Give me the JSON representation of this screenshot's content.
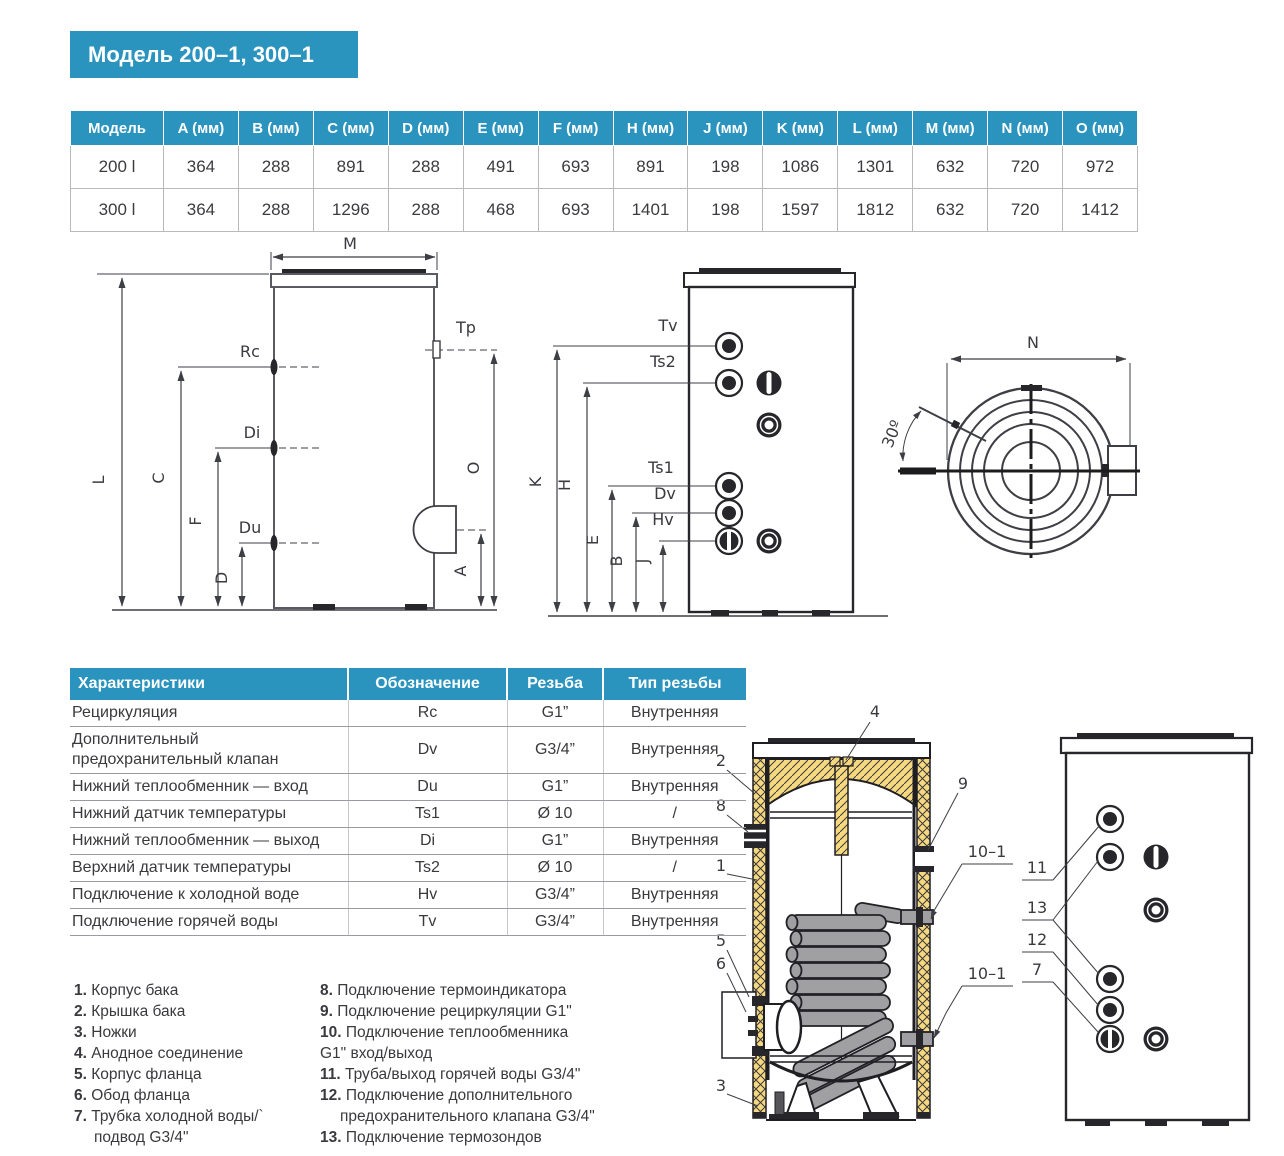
{
  "page": {
    "title": "Модель 200–1, 300–1"
  },
  "colors": {
    "accent": "#2b94be",
    "insulation": "#f6d87e",
    "line": "#3e3f45",
    "dark": "#1f1f23"
  },
  "dim_table": {
    "headers": [
      "Модель",
      "A (мм)",
      "B (мм)",
      "C (мм)",
      "D (мм)",
      "E (мм)",
      "F (мм)",
      "H (мм)",
      "J (мм)",
      "K (мм)",
      "L (мм)",
      "M (мм)",
      "N (мм)",
      "O (мм)"
    ],
    "rows": [
      [
        "200 l",
        "364",
        "288",
        "891",
        "288",
        "491",
        "693",
        "891",
        "198",
        "1086",
        "1301",
        "632",
        "720",
        "972"
      ],
      [
        "300 l",
        "364",
        "288",
        "1296",
        "288",
        "468",
        "693",
        "1401",
        "198",
        "1597",
        "1812",
        "632",
        "720",
        "1412"
      ]
    ]
  },
  "char_table": {
    "headers": [
      "Характеристики",
      "Обозначение",
      "Резьба",
      "Тип резьбы"
    ],
    "rows": [
      [
        "Рециркуляция",
        "Rc",
        "G1”",
        "Внутренняя"
      ],
      [
        "Дополнительный предохранительный клапан",
        "Dv",
        "G3/4”",
        "Внутренняя"
      ],
      [
        "Нижний теплообменник — вход",
        "Du",
        "G1”",
        "Внутренняя"
      ],
      [
        "Нижний датчик температуры",
        "Ts1",
        "Ø 10",
        "/"
      ],
      [
        "Нижний теплообменник  — выход",
        "Di",
        "G1”",
        "Внутренняя"
      ],
      [
        "Верхний датчик температуры",
        "Ts2",
        "Ø 10",
        "/"
      ],
      [
        "Подключение к холодной воде",
        "Hv",
        "G3/4”",
        "Внутренняя"
      ],
      [
        "Подключение горячей воды",
        "Tv",
        "G3/4”",
        "Внутренняя"
      ]
    ]
  },
  "legend_left": [
    {
      "num": "1",
      "lines": [
        "Корпус бака"
      ]
    },
    {
      "num": "2",
      "lines": [
        "Крышка бака"
      ]
    },
    {
      "num": "3",
      "lines": [
        "Ножки"
      ]
    },
    {
      "num": "4",
      "lines": [
        "Анодное соединение"
      ]
    },
    {
      "num": "5",
      "lines": [
        "Корпус фланца"
      ]
    },
    {
      "num": "6",
      "lines": [
        "Обод фланца"
      ]
    },
    {
      "num": "7",
      "lines": [
        "Трубка холодной воды/`",
        "подвод G3/4\""
      ],
      "indent": true
    }
  ],
  "legend_right": [
    {
      "num": "8",
      "lines": [
        "Подключение термоиндикатора"
      ]
    },
    {
      "num": "9",
      "lines": [
        "Подключение рециркуляции G1\""
      ]
    },
    {
      "num": "10",
      "lines": [
        "Подключение теплообменника",
        "G1\" вход/выход"
      ],
      "indent": false
    },
    {
      "num": "11",
      "lines": [
        "Труба/выход горячей воды G3/4\""
      ]
    },
    {
      "num": "12",
      "lines": [
        "Подключение дополнительного",
        "предохранительного клапана G3/4\""
      ],
      "indent": true
    },
    {
      "num": "13",
      "lines": [
        "Подключение термозондов"
      ]
    }
  ],
  "drawings": {
    "side_view": {
      "labels": {
        "M": "M",
        "L": "L",
        "C": "C",
        "F": "F",
        "D": "D",
        "Rc": "Rc",
        "Di": "Di",
        "Du": "Du",
        "Tp": "Tp",
        "O": "O",
        "A": "A"
      }
    },
    "front_view": {
      "labels": {
        "K": "K",
        "H": "H",
        "E": "E",
        "B": "B",
        "J": "J",
        "Tv": "Tv",
        "Ts2": "Ts2",
        "Ts1": "Ts1",
        "Dv": "Dv",
        "Hv": "Hv"
      }
    },
    "top_view": {
      "labels": {
        "N": "N",
        "angle": "30º"
      }
    },
    "cross_section": {
      "callouts": {
        "n1": "1",
        "n2": "2",
        "n3": "3",
        "n4": "4",
        "n5": "5",
        "n6": "6",
        "n8": "8",
        "n9": "9",
        "n10a": "10–1",
        "n10b": "10–1"
      }
    },
    "ports_view": {
      "callouts": {
        "n7": "7",
        "n11": "11",
        "n12": "12",
        "n13": "13"
      }
    }
  }
}
